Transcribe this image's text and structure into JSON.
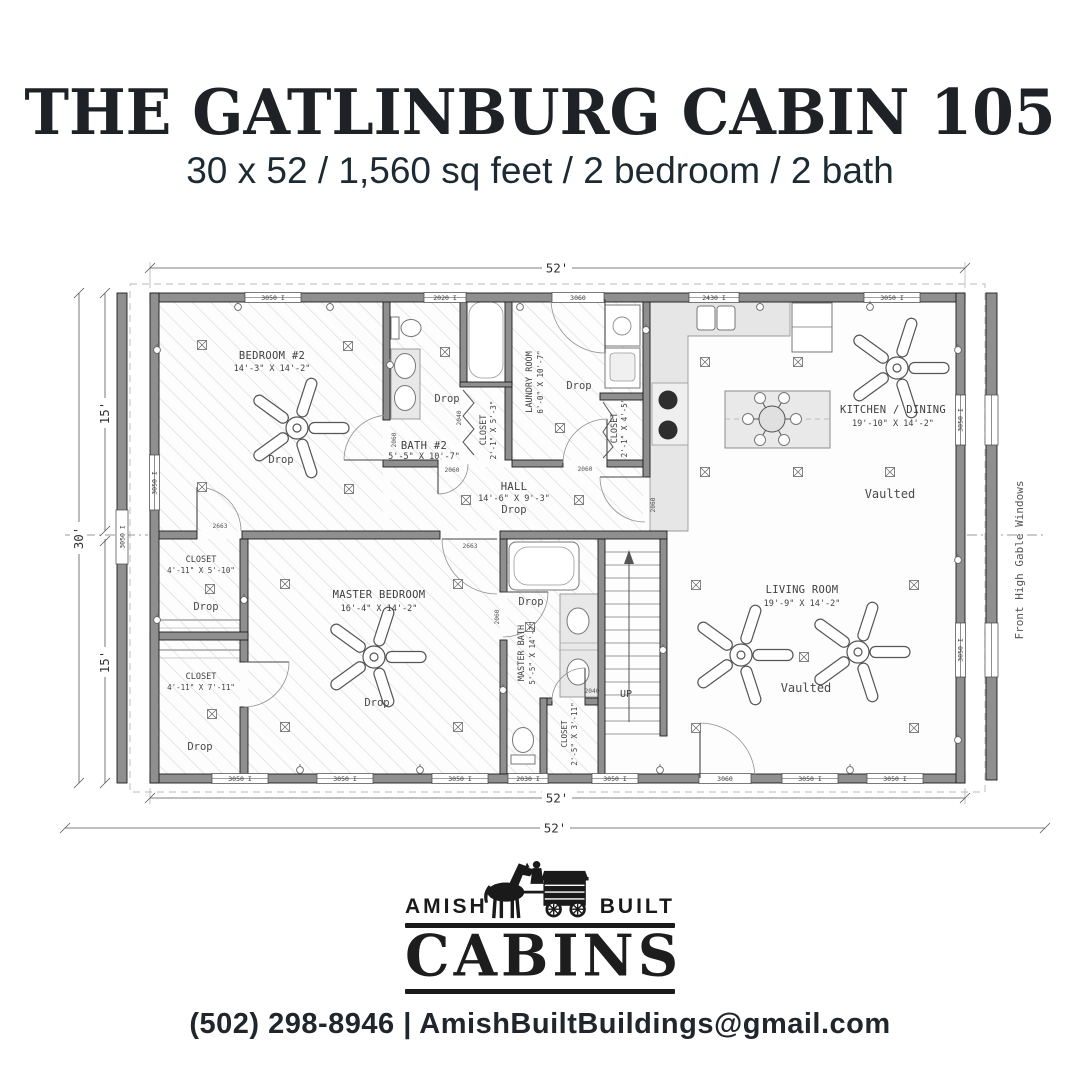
{
  "header": {
    "title": "THE GATLINBURG CABIN 105",
    "subtitle": "30 x 52 / 1,560 sq feet / 2 bedroom / 2 bath"
  },
  "plan": {
    "overall": {
      "width_top": "52'",
      "width_bottom": "52'",
      "width_overall": "52'",
      "depth": "30'",
      "depth_upper": "15'",
      "depth_lower": "15'"
    },
    "side_note": "Front High Gable Windows",
    "rooms": {
      "bedroom2": {
        "name": "BEDROOM #2",
        "size": "14'-3\" X 14'-2\"",
        "ceiling": "Drop"
      },
      "bath2": {
        "name": "BATH #2",
        "size": "5'-5\" X 10'-7\"",
        "ceiling": "Drop"
      },
      "bath2_closet": {
        "name": "CLOSET",
        "size": "2'-1\" X 5'-3\""
      },
      "laundry": {
        "name": "LAUNDRY ROOM",
        "size": "6'-0\" X 10'-7\"",
        "ceiling": "Drop"
      },
      "laundry_closet": {
        "name": "CLOSET",
        "size": "2'-1\" X 4'-5\""
      },
      "hall": {
        "name": "HALL",
        "size": "14'-6\" X 9'-3\"",
        "ceiling": "Drop"
      },
      "kitchen": {
        "name": "KITCHEN / DINING",
        "size": "19'-10\" X 14'-2\"",
        "ceiling": "Vaulted"
      },
      "closet1": {
        "name": "CLOSET",
        "size": "4'-11\" X 5'-10\"",
        "ceiling": "Drop"
      },
      "closet2": {
        "name": "CLOSET",
        "size": "4'-11\" X 7'-11\"",
        "ceiling": "Drop"
      },
      "master": {
        "name": "MASTER BEDROOM",
        "size": "16'-4\" X 14'-2\"",
        "ceiling": "Drop"
      },
      "master_bath": {
        "name": "MASTER BATH",
        "size": "5'-5\" X 14'-2\"",
        "ceiling": "Drop"
      },
      "stair_closet": {
        "name": "CLOSET",
        "size": "2'-5\" X 3'-11\""
      },
      "living": {
        "name": "LIVING ROOM",
        "size": "19'-9\" X 14'-2\"",
        "ceiling": "Vaulted"
      }
    },
    "stairs": {
      "label": "UP"
    },
    "windows": {
      "top": [
        "3050 I",
        "2020 I",
        "3060",
        "2430 I",
        "3050 I"
      ],
      "bottom": [
        "3050 I",
        "3050 I",
        "3050 I",
        "2030 I",
        "3050 I",
        "3060",
        "3050 I",
        "3050 I"
      ],
      "left": [
        "3050 I",
        "3050 I"
      ],
      "right": [
        "3050 I",
        "3050 I"
      ]
    },
    "door_tags": [
      "2663",
      "2663",
      "2060",
      "2060",
      "2040",
      "2060",
      "2060",
      "2040",
      "2060"
    ]
  },
  "logo": {
    "word_left": "AMISH",
    "word_right": "BUILT",
    "word_main": "CABINS"
  },
  "footer": {
    "contact": "(502) 298-8946 | AmishBuiltBuildings@gmail.com"
  }
}
